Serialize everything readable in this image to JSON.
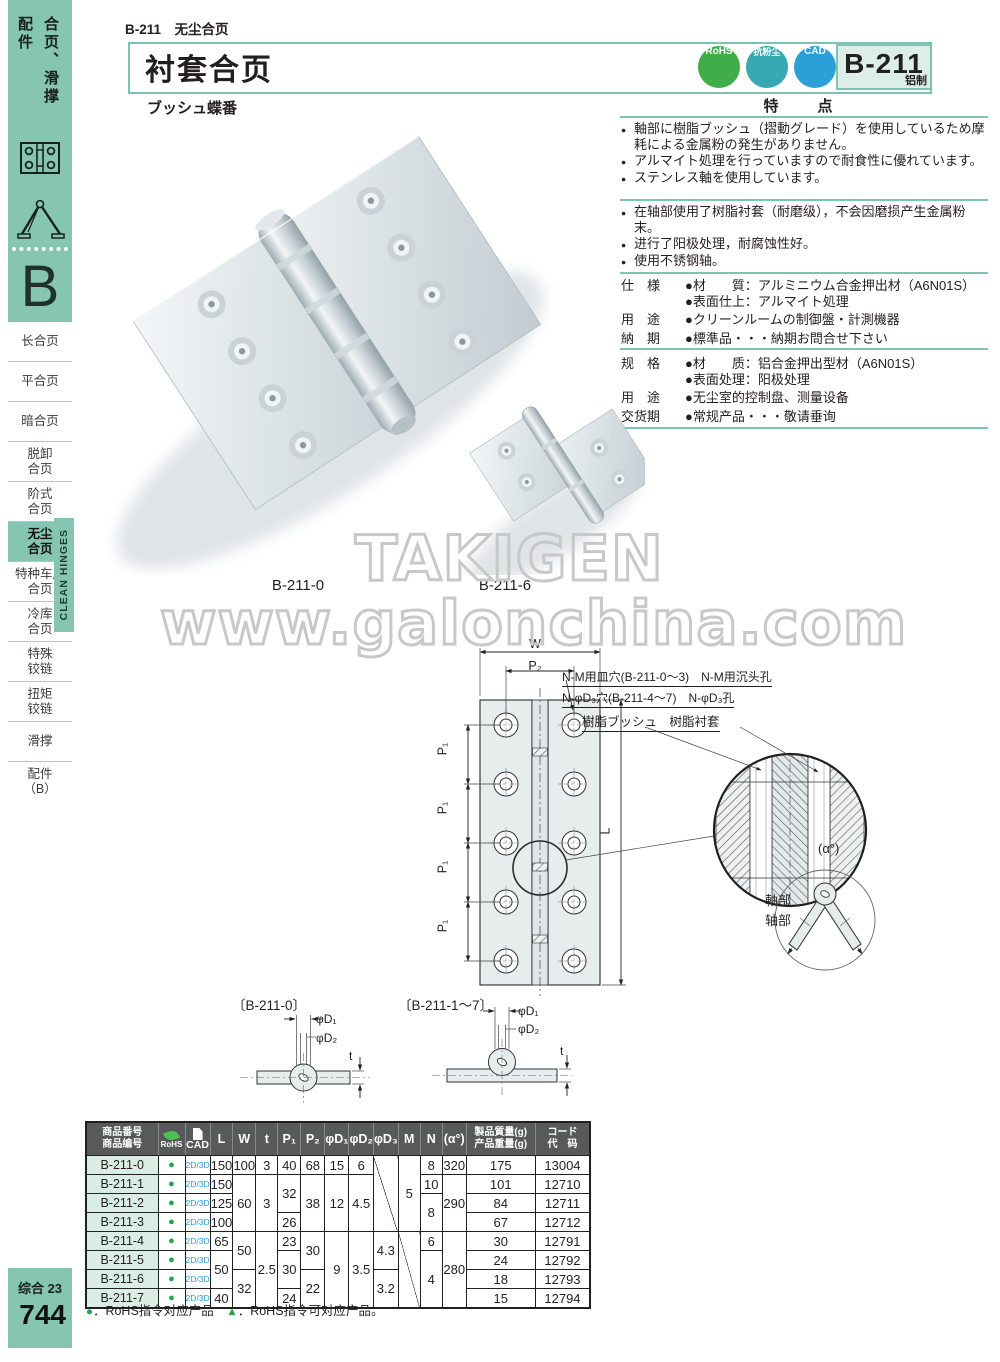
{
  "page": {
    "topbar": "B-211　无尘合页",
    "title": "衬套合页",
    "subtitle": "ブッシュ蝶番",
    "model": "B-211",
    "model_sub": "铝制",
    "features_title": "特　点"
  },
  "badges": [
    {
      "name": "rohs",
      "label": "RoHS"
    },
    {
      "name": "dust",
      "label": "抗粉尘"
    },
    {
      "name": "cad",
      "label": "CAD"
    }
  ],
  "sidebar": {
    "cat_left": "配件",
    "cat_right": "合页、滑撑",
    "chapter": "B",
    "clean_tab": "CLEAN HINGES",
    "footer_label": "综合 23",
    "page_number": "744",
    "items": [
      {
        "lines": [
          "长合页"
        ]
      },
      {
        "lines": [
          "平合页"
        ]
      },
      {
        "lines": [
          "暗合页"
        ]
      },
      {
        "lines": [
          "脱卸",
          "合页"
        ]
      },
      {
        "lines": [
          "阶式",
          "合页"
        ]
      },
      {
        "lines": [
          "无尘",
          "合页"
        ],
        "active": true
      },
      {
        "lines": [
          "特种车用",
          "合页"
        ]
      },
      {
        "lines": [
          "冷库",
          "合页"
        ]
      },
      {
        "lines": [
          "特殊",
          "铰链"
        ]
      },
      {
        "lines": [
          "扭矩",
          "铰链"
        ]
      },
      {
        "lines": [
          "滑撑"
        ]
      },
      {
        "lines": [
          "配件",
          "（B）"
        ]
      }
    ]
  },
  "features": {
    "jp": [
      "軸部に樹脂ブッシュ（摺動グレード）を使用しているため摩耗による金属粉の発生がありません。",
      "アルマイト処理を行っていますので耐食性に優れています。",
      "ステンレス軸を使用しています。"
    ],
    "cn": [
      "在轴部使用了树脂衬套（耐磨级），不会因磨损产生金属粉末。",
      "进行了阳极处理，耐腐蚀性好。",
      "使用不锈钢轴。"
    ]
  },
  "specs_jp": [
    {
      "label": "仕　様",
      "lines": [
        "●材　　質：アルミニウム合金押出材（A6N01S）",
        "●表面仕上：アルマイト処理"
      ]
    },
    {
      "label": "用　途",
      "lines": [
        "●クリーンルームの制御盤・計測機器"
      ]
    },
    {
      "label": "納　期",
      "lines": [
        "●標準品・・・納期お問合せ下さい"
      ]
    }
  ],
  "specs_cn": [
    {
      "label": "规　格",
      "lines": [
        "●材　　质：铝合金押出型材（A6N01S）",
        "●表面处理：阳极处理"
      ]
    },
    {
      "label": "用　途",
      "lines": [
        "●无尘室的控制盘、测量设备"
      ]
    },
    {
      "label": "交货期",
      "lines": [
        "●常规产品・・・敬请垂询"
      ]
    }
  ],
  "photo": {
    "label_large": "B-211-0",
    "label_small": "B-211-6",
    "watermark_top": "TAKIGEN",
    "watermark_bottom": "www.galonchina.com"
  },
  "drawing": {
    "w": "W",
    "p2": "P₂",
    "p1": "P₁",
    "l": "L",
    "alpha": "(α°)",
    "note1": "N-M用皿穴(B-211-0～3)　N-M用沉头孔",
    "note2": "N-φD₃穴(B-211-4～7)　N-φD₃孔",
    "bush": "樹脂ブッシュ　树脂衬套",
    "shaft_jp": "軸部",
    "shaft_cn": "轴部",
    "sec0": "〔B-211-0〕",
    "sec17": "〔B-211-1～7〕",
    "d1": "φD₁",
    "d2": "φD₂",
    "t": "t"
  },
  "table": {
    "header": [
      {
        "key": "product",
        "jp": "商品番号",
        "cn": "商品编号"
      },
      {
        "key": "rohs",
        "label": "RoHS",
        "icon": "leaf"
      },
      {
        "key": "cad",
        "label": "CAD",
        "icon": "doc"
      },
      {
        "key": "L",
        "label": "L"
      },
      {
        "key": "W",
        "label": "W"
      },
      {
        "key": "t",
        "label": "t"
      },
      {
        "key": "P1",
        "label": "P₁"
      },
      {
        "key": "P2",
        "label": "P₂"
      },
      {
        "key": "D1",
        "label": "φD₁"
      },
      {
        "key": "D2",
        "label": "φD₂"
      },
      {
        "key": "D3",
        "label": "φD₃"
      },
      {
        "key": "M",
        "label": "M"
      },
      {
        "key": "N",
        "label": "N"
      },
      {
        "key": "alpha",
        "label": "(α°)"
      },
      {
        "key": "weight",
        "jp": "製品質量(g)",
        "cn": "产品重量(g)"
      },
      {
        "key": "code",
        "jp": "コード",
        "cn": "代　码"
      }
    ],
    "columns": {
      "product": [
        "B-211-0",
        "B-211-1",
        "B-211-2",
        "B-211-3",
        "B-211-4",
        "B-211-5",
        "B-211-6",
        "B-211-7"
      ],
      "rohs": [
        "●",
        "●",
        "●",
        "●",
        "●",
        "●",
        "●",
        "●"
      ],
      "cad": [
        "2D/3D",
        "2D/3D",
        "2D/3D",
        "2D/3D",
        "2D/3D",
        "2D/3D",
        "2D/3D",
        "2D/3D"
      ],
      "L": [
        {
          "v": "150"
        },
        {
          "v": "150"
        },
        {
          "v": "125"
        },
        {
          "v": "100"
        },
        {
          "v": "65"
        },
        {
          "v": "50",
          "span": 2
        },
        {
          "v": "40"
        }
      ],
      "W": [
        {
          "v": "100"
        },
        {
          "v": "60",
          "span": 3
        },
        {
          "v": "50",
          "span": 2
        },
        {
          "v": "32",
          "span": 2
        }
      ],
      "t": [
        {
          "v": "3"
        },
        {
          "v": "3",
          "span": 3
        },
        {
          "v": "2.5",
          "span": 4
        }
      ],
      "P1": [
        {
          "v": "40"
        },
        {
          "v": "32",
          "span": 2
        },
        {
          "v": "26"
        },
        {
          "v": "23"
        },
        {
          "v": "30",
          "span": 2
        },
        {
          "v": "24"
        }
      ],
      "P2": [
        {
          "v": "68"
        },
        {
          "v": "38",
          "span": 3
        },
        {
          "v": "30",
          "span": 2
        },
        {
          "v": "22",
          "span": 2
        }
      ],
      "D1": [
        {
          "v": "15"
        },
        {
          "v": "12",
          "span": 3
        },
        {
          "v": "9",
          "span": 4
        }
      ],
      "D2": [
        {
          "v": "6"
        },
        {
          "v": "4.5",
          "span": 3
        },
        {
          "v": "3.5",
          "span": 4
        }
      ],
      "D3": [
        {
          "diag": true,
          "span": 4
        },
        {
          "v": "4.3",
          "span": 2
        },
        {
          "v": "3.2",
          "span": 2
        }
      ],
      "M": [
        {
          "v": "5",
          "span": 4
        },
        {
          "diag": true,
          "span": 4
        }
      ],
      "N": [
        {
          "v": "8"
        },
        {
          "v": "10"
        },
        {
          "v": "8",
          "span": 2
        },
        {
          "v": "6"
        },
        {
          "v": "4",
          "span": 3
        }
      ],
      "alpha": [
        {
          "v": "320"
        },
        {
          "v": "290",
          "span": 3
        },
        {
          "v": "280",
          "span": 4
        }
      ],
      "weight": [
        "175",
        "101",
        "84",
        "67",
        "30",
        "24",
        "18",
        "15"
      ],
      "code": [
        "13004",
        "12710",
        "12711",
        "12712",
        "12791",
        "12792",
        "12793",
        "12794"
      ]
    },
    "note_parts": [
      "●",
      "：RoHS指令对应产品　",
      "▲",
      "：RoHS指令可对应产品。"
    ]
  },
  "colors": {
    "teal": "#85C5B2",
    "mint": "#D9EDE4",
    "green": "#21A44C",
    "blue": "#2B9FD8",
    "dust": "#36A9B2",
    "table_header": "#58595B",
    "ink": "#231F20",
    "watermark": "#C8C8C8"
  }
}
